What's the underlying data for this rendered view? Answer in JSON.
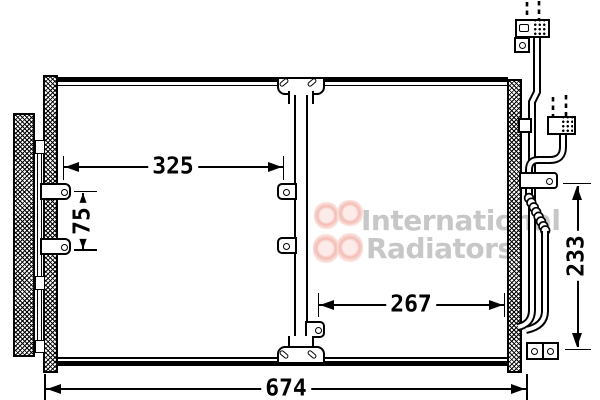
{
  "diagram": {
    "kind": "condenser-technical-drawing",
    "colors": {
      "line": "#000000",
      "background": "#ffffff",
      "watermark_text": "#c7c7c7",
      "watermark_logo": "#f4bcb4"
    },
    "dimensions": {
      "upper_width": {
        "value": "325",
        "orientation": "horizontal"
      },
      "left_height": {
        "value": "75",
        "orientation": "vertical"
      },
      "lower_width": {
        "value": "267",
        "orientation": "horizontal"
      },
      "right_height": {
        "value": "233",
        "orientation": "vertical"
      },
      "overall_width": {
        "value": "674",
        "orientation": "horizontal"
      }
    },
    "watermark": {
      "line1": "International",
      "line2": "Radiators"
    }
  }
}
